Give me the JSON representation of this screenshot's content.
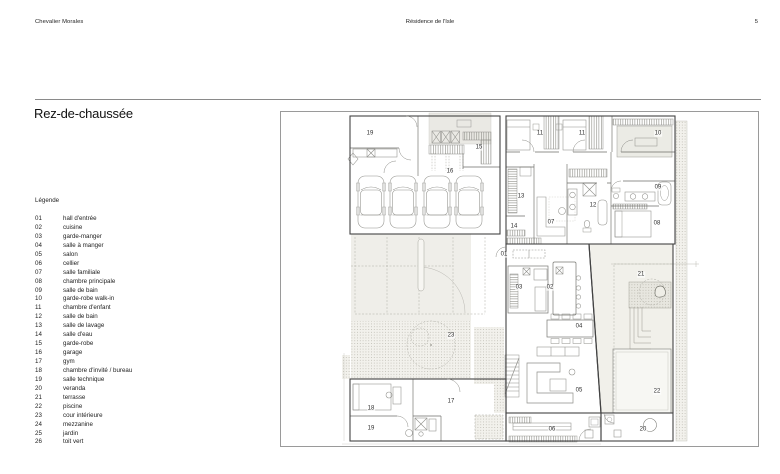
{
  "header": {
    "left": "Chevalier Morales",
    "center": "Résidence de l'Isle",
    "page": "5"
  },
  "title": "Rez-de-chaussée",
  "legend": {
    "heading": "Légende",
    "items": [
      {
        "code": "01",
        "label": "hall d'entrée"
      },
      {
        "code": "02",
        "label": "cuisine"
      },
      {
        "code": "03",
        "label": "garde-manger"
      },
      {
        "code": "04",
        "label": "salle à manger"
      },
      {
        "code": "05",
        "label": "salon"
      },
      {
        "code": "06",
        "label": "cellier"
      },
      {
        "code": "07",
        "label": "salle familiale"
      },
      {
        "code": "08",
        "label": "chambre principale"
      },
      {
        "code": "09",
        "label": "salle de bain"
      },
      {
        "code": "10",
        "label": "garde-robe walk-in"
      },
      {
        "code": "11",
        "label": "chambre d'enfant"
      },
      {
        "code": "12",
        "label": "salle de bain"
      },
      {
        "code": "13",
        "label": "salle de lavage"
      },
      {
        "code": "14",
        "label": "salle d'eau"
      },
      {
        "code": "15",
        "label": "garde-robe"
      },
      {
        "code": "16",
        "label": "garage"
      },
      {
        "code": "17",
        "label": "gym"
      },
      {
        "code": "18",
        "label": "chambre d'invité / bureau"
      },
      {
        "code": "19",
        "label": "salle technique"
      },
      {
        "code": "20",
        "label": "veranda"
      },
      {
        "code": "21",
        "label": "terrasse"
      },
      {
        "code": "22",
        "label": "piscine"
      },
      {
        "code": "23",
        "label": "cour intérieure"
      },
      {
        "code": "24",
        "label": "mezzanine"
      },
      {
        "code": "25",
        "label": "jardin"
      },
      {
        "code": "26",
        "label": "toit vert"
      }
    ]
  },
  "plan": {
    "labels": [
      {
        "text": "19",
        "x": 369,
        "y": 133
      },
      {
        "text": "15",
        "x": 478,
        "y": 147
      },
      {
        "text": "16",
        "x": 449,
        "y": 171
      },
      {
        "text": "11",
        "x": 539,
        "y": 133
      },
      {
        "text": "11",
        "x": 581,
        "y": 133
      },
      {
        "text": "10",
        "x": 657,
        "y": 133
      },
      {
        "text": "13",
        "x": 520,
        "y": 196
      },
      {
        "text": "12",
        "x": 592,
        "y": 205
      },
      {
        "text": "09",
        "x": 657,
        "y": 187
      },
      {
        "text": "08",
        "x": 656,
        "y": 223
      },
      {
        "text": "14",
        "x": 513,
        "y": 226
      },
      {
        "text": "07",
        "x": 550,
        "y": 222
      },
      {
        "text": "01",
        "x": 503,
        "y": 254
      },
      {
        "text": "03",
        "x": 518,
        "y": 287
      },
      {
        "text": "02",
        "x": 549,
        "y": 287
      },
      {
        "text": "21",
        "x": 640,
        "y": 274
      },
      {
        "text": "04",
        "x": 578,
        "y": 326
      },
      {
        "text": "23",
        "x": 450,
        "y": 335
      },
      {
        "text": "05",
        "x": 578,
        "y": 390
      },
      {
        "text": "22",
        "x": 656,
        "y": 391
      },
      {
        "text": "17",
        "x": 450,
        "y": 401
      },
      {
        "text": "18",
        "x": 370,
        "y": 408
      },
      {
        "text": "19",
        "x": 370,
        "y": 428
      },
      {
        "text": "06",
        "x": 551,
        "y": 429
      },
      {
        "text": "20",
        "x": 642,
        "y": 429
      }
    ]
  }
}
